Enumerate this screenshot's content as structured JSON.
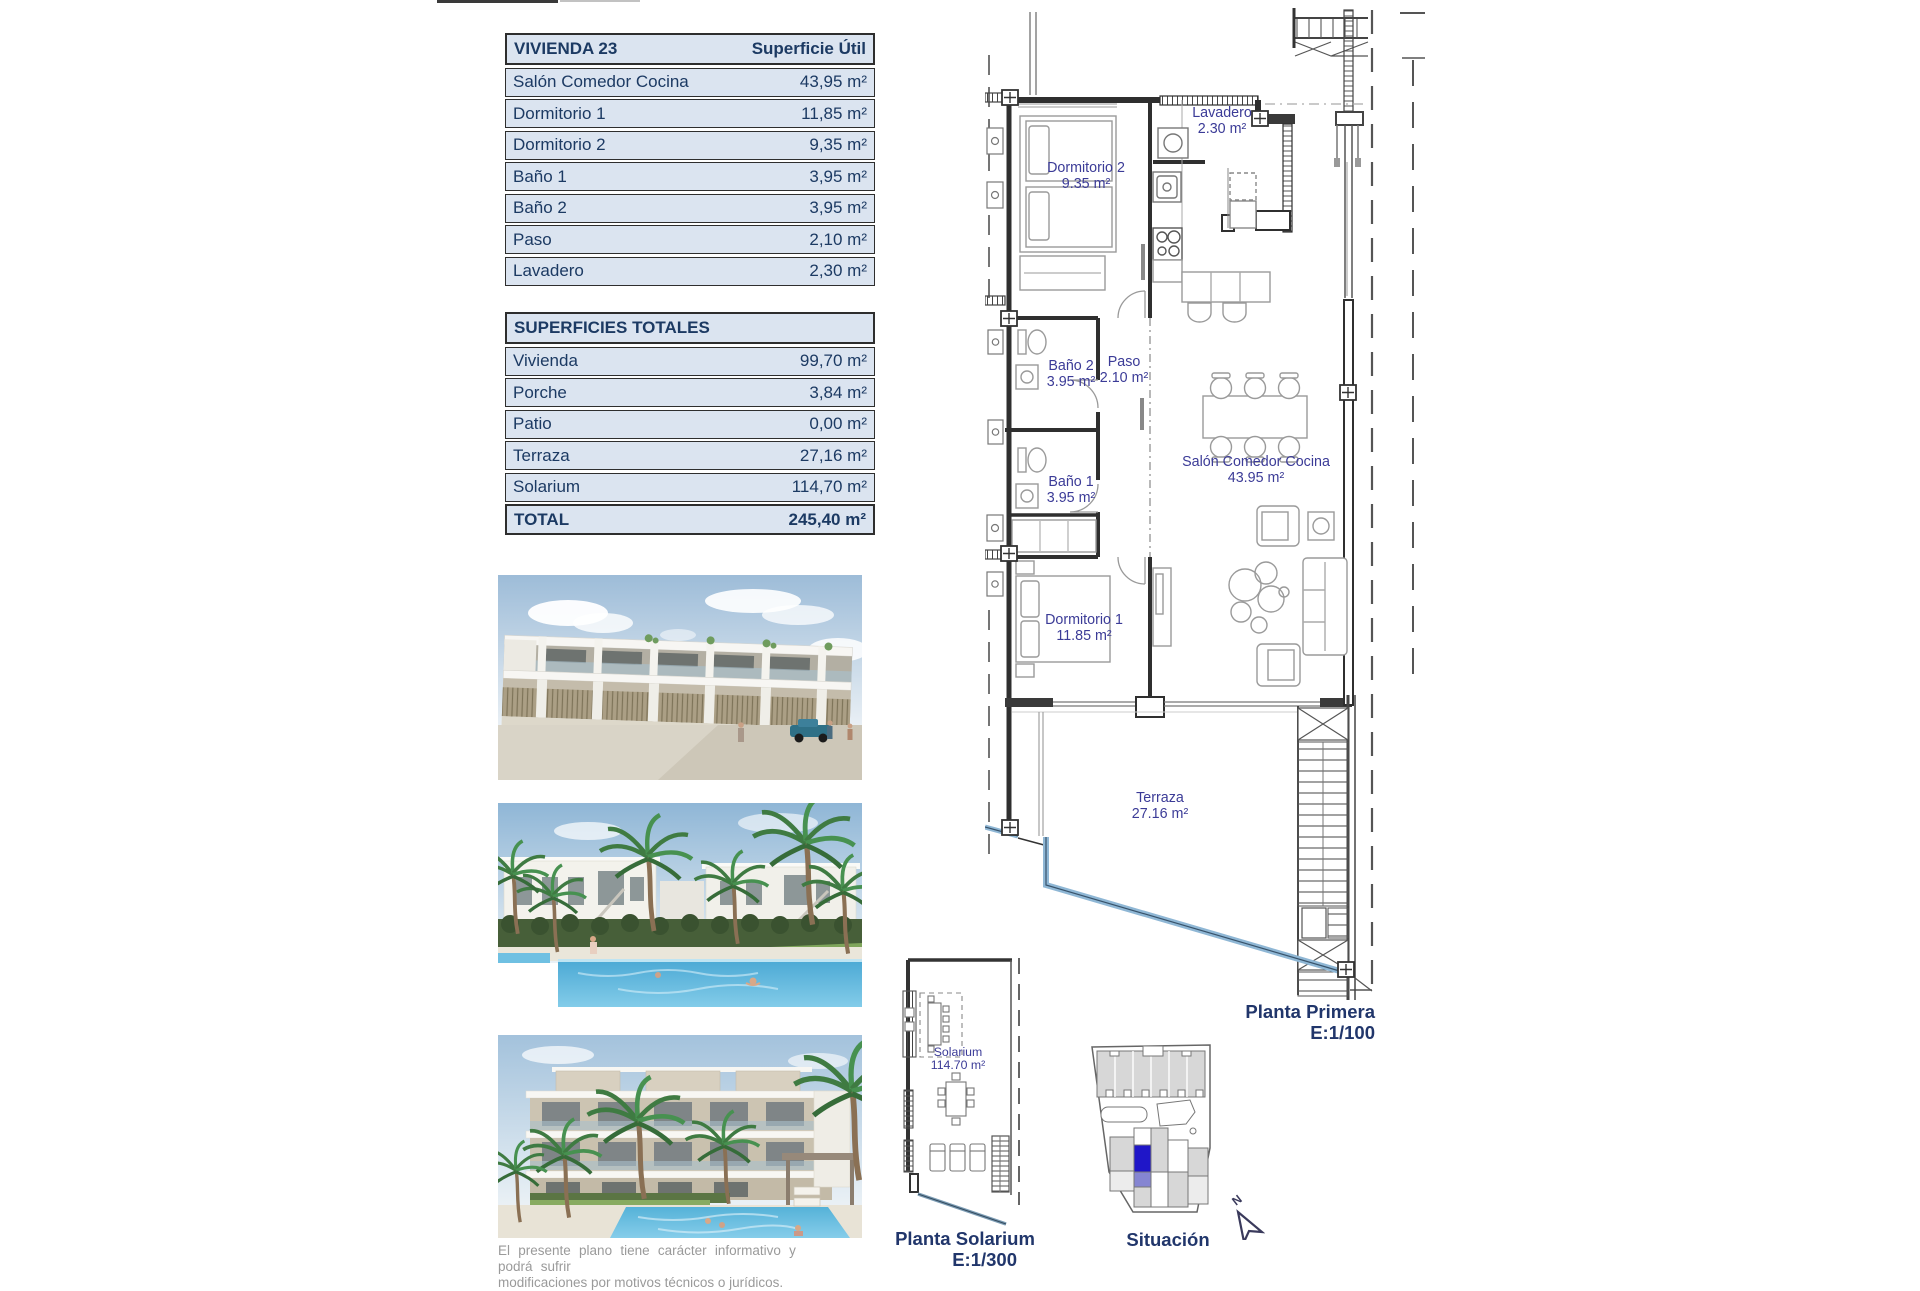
{
  "tables": {
    "vivienda": {
      "title": "VIVIENDA 23",
      "header_value": "Superficie Útil",
      "rows": [
        {
          "label": "Salón Comedor Cocina",
          "value": "43,95 m²"
        },
        {
          "label": "Dormitorio 1",
          "value": "11,85 m²"
        },
        {
          "label": "Dormitorio 2",
          "value": "9,35 m²"
        },
        {
          "label": "Baño 1",
          "value": "3,95 m²"
        },
        {
          "label": "Baño 2",
          "value": "3,95 m²"
        },
        {
          "label": "Paso",
          "value": "2,10 m²"
        },
        {
          "label": "Lavadero",
          "value": "2,30 m²"
        }
      ]
    },
    "totales": {
      "title": "SUPERFICIES TOTALES",
      "rows": [
        {
          "label": "Vivienda",
          "value": "99,70 m²"
        },
        {
          "label": "Porche",
          "value": "3,84 m²"
        },
        {
          "label": "Patio",
          "value": "0,00 m²"
        },
        {
          "label": "Terraza",
          "value": "27,16 m²"
        },
        {
          "label": "Solarium",
          "value": "114,70 m²"
        }
      ],
      "total": {
        "label": "TOTAL",
        "value": "245,40 m²"
      }
    }
  },
  "floorplan": {
    "caption": "Planta Primera",
    "scale": "E:1/100",
    "rooms": [
      {
        "name": "Lavadero",
        "area": "2.30 m²"
      },
      {
        "name": "Dormitorio 2",
        "area": "9.35 m²"
      },
      {
        "name": "Baño 2",
        "area": "3.95 m²"
      },
      {
        "name": "Paso",
        "area": "2.10 m²"
      },
      {
        "name": "Baño 1",
        "area": "3.95 m²"
      },
      {
        "name": "Salón Comedor Cocina",
        "area": "43.95 m²"
      },
      {
        "name": "Dormitorio 1",
        "area": "11.85 m²"
      },
      {
        "name": "Terraza",
        "area": "27.16 m²"
      }
    ]
  },
  "solarium": {
    "caption": "Planta Solarium",
    "scale": "E:1/300",
    "room": {
      "name": "Solarium",
      "area": "114.70 m²"
    }
  },
  "situacion": {
    "caption": "Situación",
    "north": "N"
  },
  "disclaimer": {
    "line1": "El presente plano tiene carácter informativo y podrá sufrir",
    "line2": "modificaciones por motivos técnicos o jurídicos."
  },
  "colors": {
    "table_bg": "#dbe4f0",
    "table_text": "#1c3a63",
    "plan_label": "#3b3b97",
    "caption_navy": "#21366b",
    "railing_blue": "#8fb7d5",
    "situacion_highlight": "#1f16c8",
    "situacion_highlight_light": "#8585d2"
  }
}
